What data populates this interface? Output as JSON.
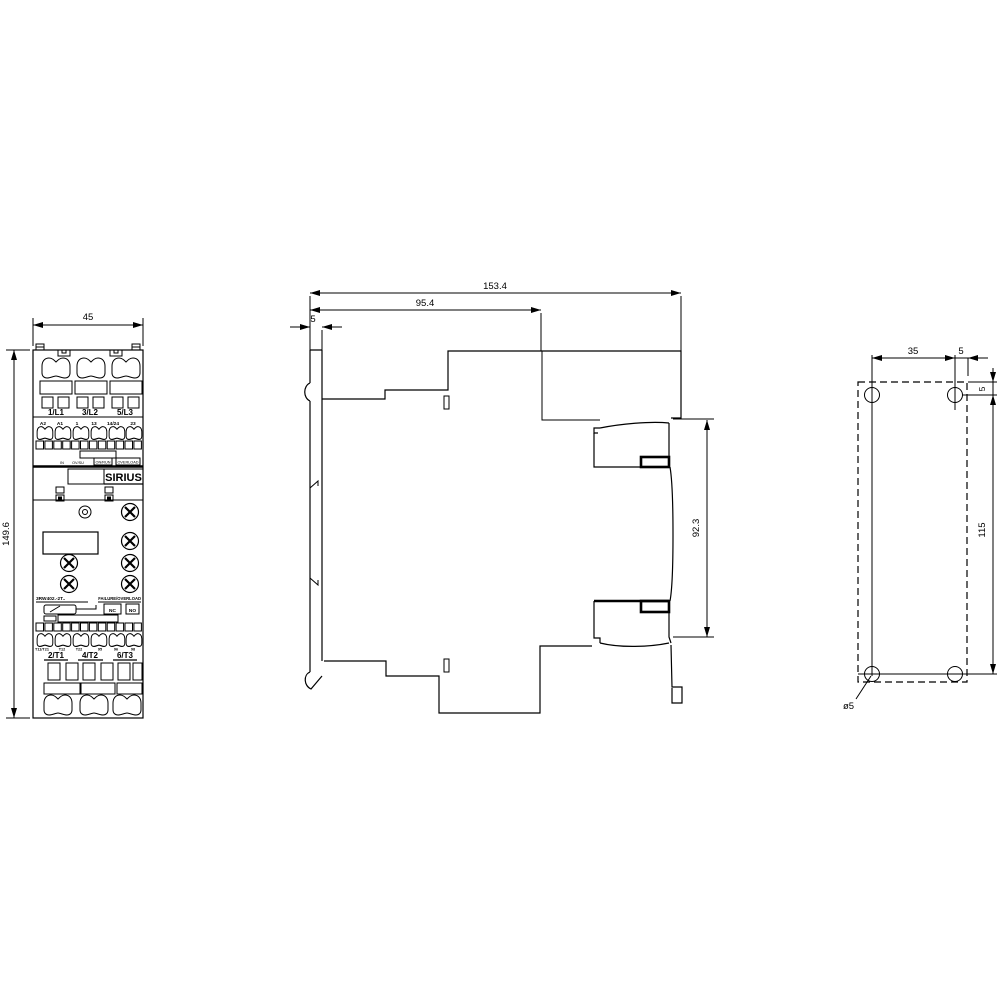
{
  "drawing": {
    "front_view": {
      "dim_width": "45",
      "dim_height": "149.6",
      "brand": "SIRIUS",
      "model_label": "3RW402.-2T..",
      "status_label": "FAILURE/OVERLOAD",
      "top_terminal_labels": [
        "1/L1",
        "3/L2",
        "5/L3"
      ],
      "control_terminal_labels": [
        "A2",
        "A1",
        "1",
        "13",
        "14/24",
        "23"
      ],
      "led_labels": [
        "IN",
        "OV/SU",
        "ON/RUN",
        "OVERLOAD"
      ],
      "relay_labels": [
        "NC",
        "NO"
      ],
      "bottom_small_labels": [
        "T11/T21",
        "T12",
        "T22",
        "95",
        "96",
        "98"
      ],
      "bottom_terminal_labels": [
        "2/T1",
        "4/T2",
        "6/T3"
      ]
    },
    "side_view": {
      "dim_total_depth": "153.4",
      "dim_body_depth": "95.4",
      "dim_plate_thickness": "5",
      "dim_terminal_span": "92.3"
    },
    "drill_view": {
      "dim_hole_spacing_horizontal": "35",
      "dim_hole_edge_horizontal": "5",
      "dim_hole_edge_vertical": "5",
      "dim_hole_spacing_vertical": "115",
      "hole_diameter": "ø5"
    }
  }
}
